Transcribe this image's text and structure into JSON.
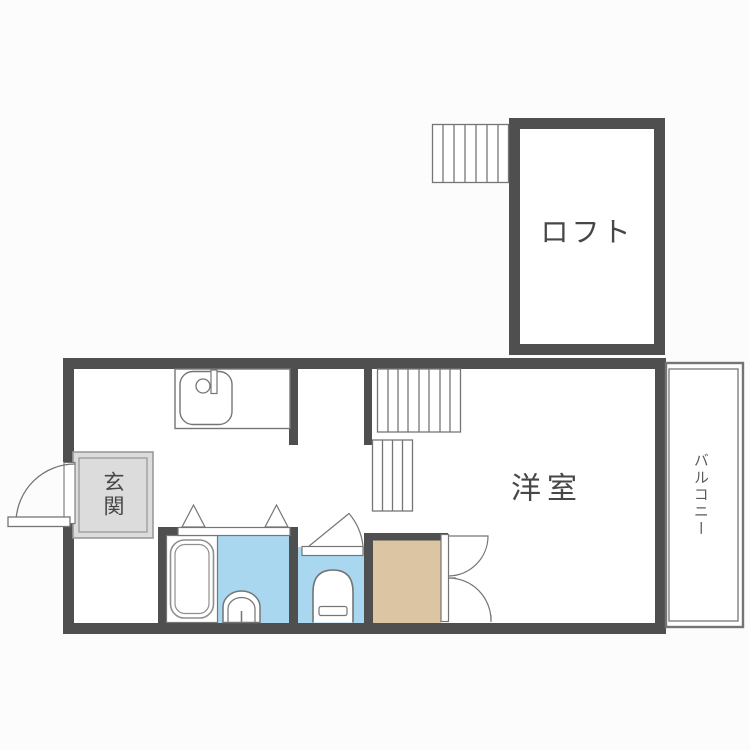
{
  "canvas": {
    "width": 750,
    "height": 750,
    "kind": "japanese-apartment-floorplan"
  },
  "labels": {
    "loft": "ロフト",
    "western_room": "洋室",
    "entrance": "玄関",
    "balcony": "バルコニー"
  },
  "colors": {
    "wall": "#4f4f4f",
    "outline": "#757575",
    "fixture-line": "#8f8f8f",
    "water": "#a8d7ef",
    "wood": "#dbc5a3",
    "entrance-fill": "#dcdcdc",
    "entrance-line": "#9a9a9a",
    "text": "#474747",
    "bg": "#fcfcfc"
  },
  "fixtures": {
    "kitchen_sink": "kitchen-sink-icon",
    "bathtub": "bathtub-icon",
    "washbasin": "washbasin-icon",
    "toilet": "toilet-icon",
    "stairs_upper": "stairs-hatch-icon",
    "stairs_lower": "stairs-hatch-icon",
    "loft_ladder": "ladder-hatch-icon",
    "entrance_door": "swing-door-icon",
    "bathroom_doors": "folding-door-triangle-icon",
    "toilet_door": "swing-door-icon",
    "closet_doors": "double-swing-door-icon"
  }
}
